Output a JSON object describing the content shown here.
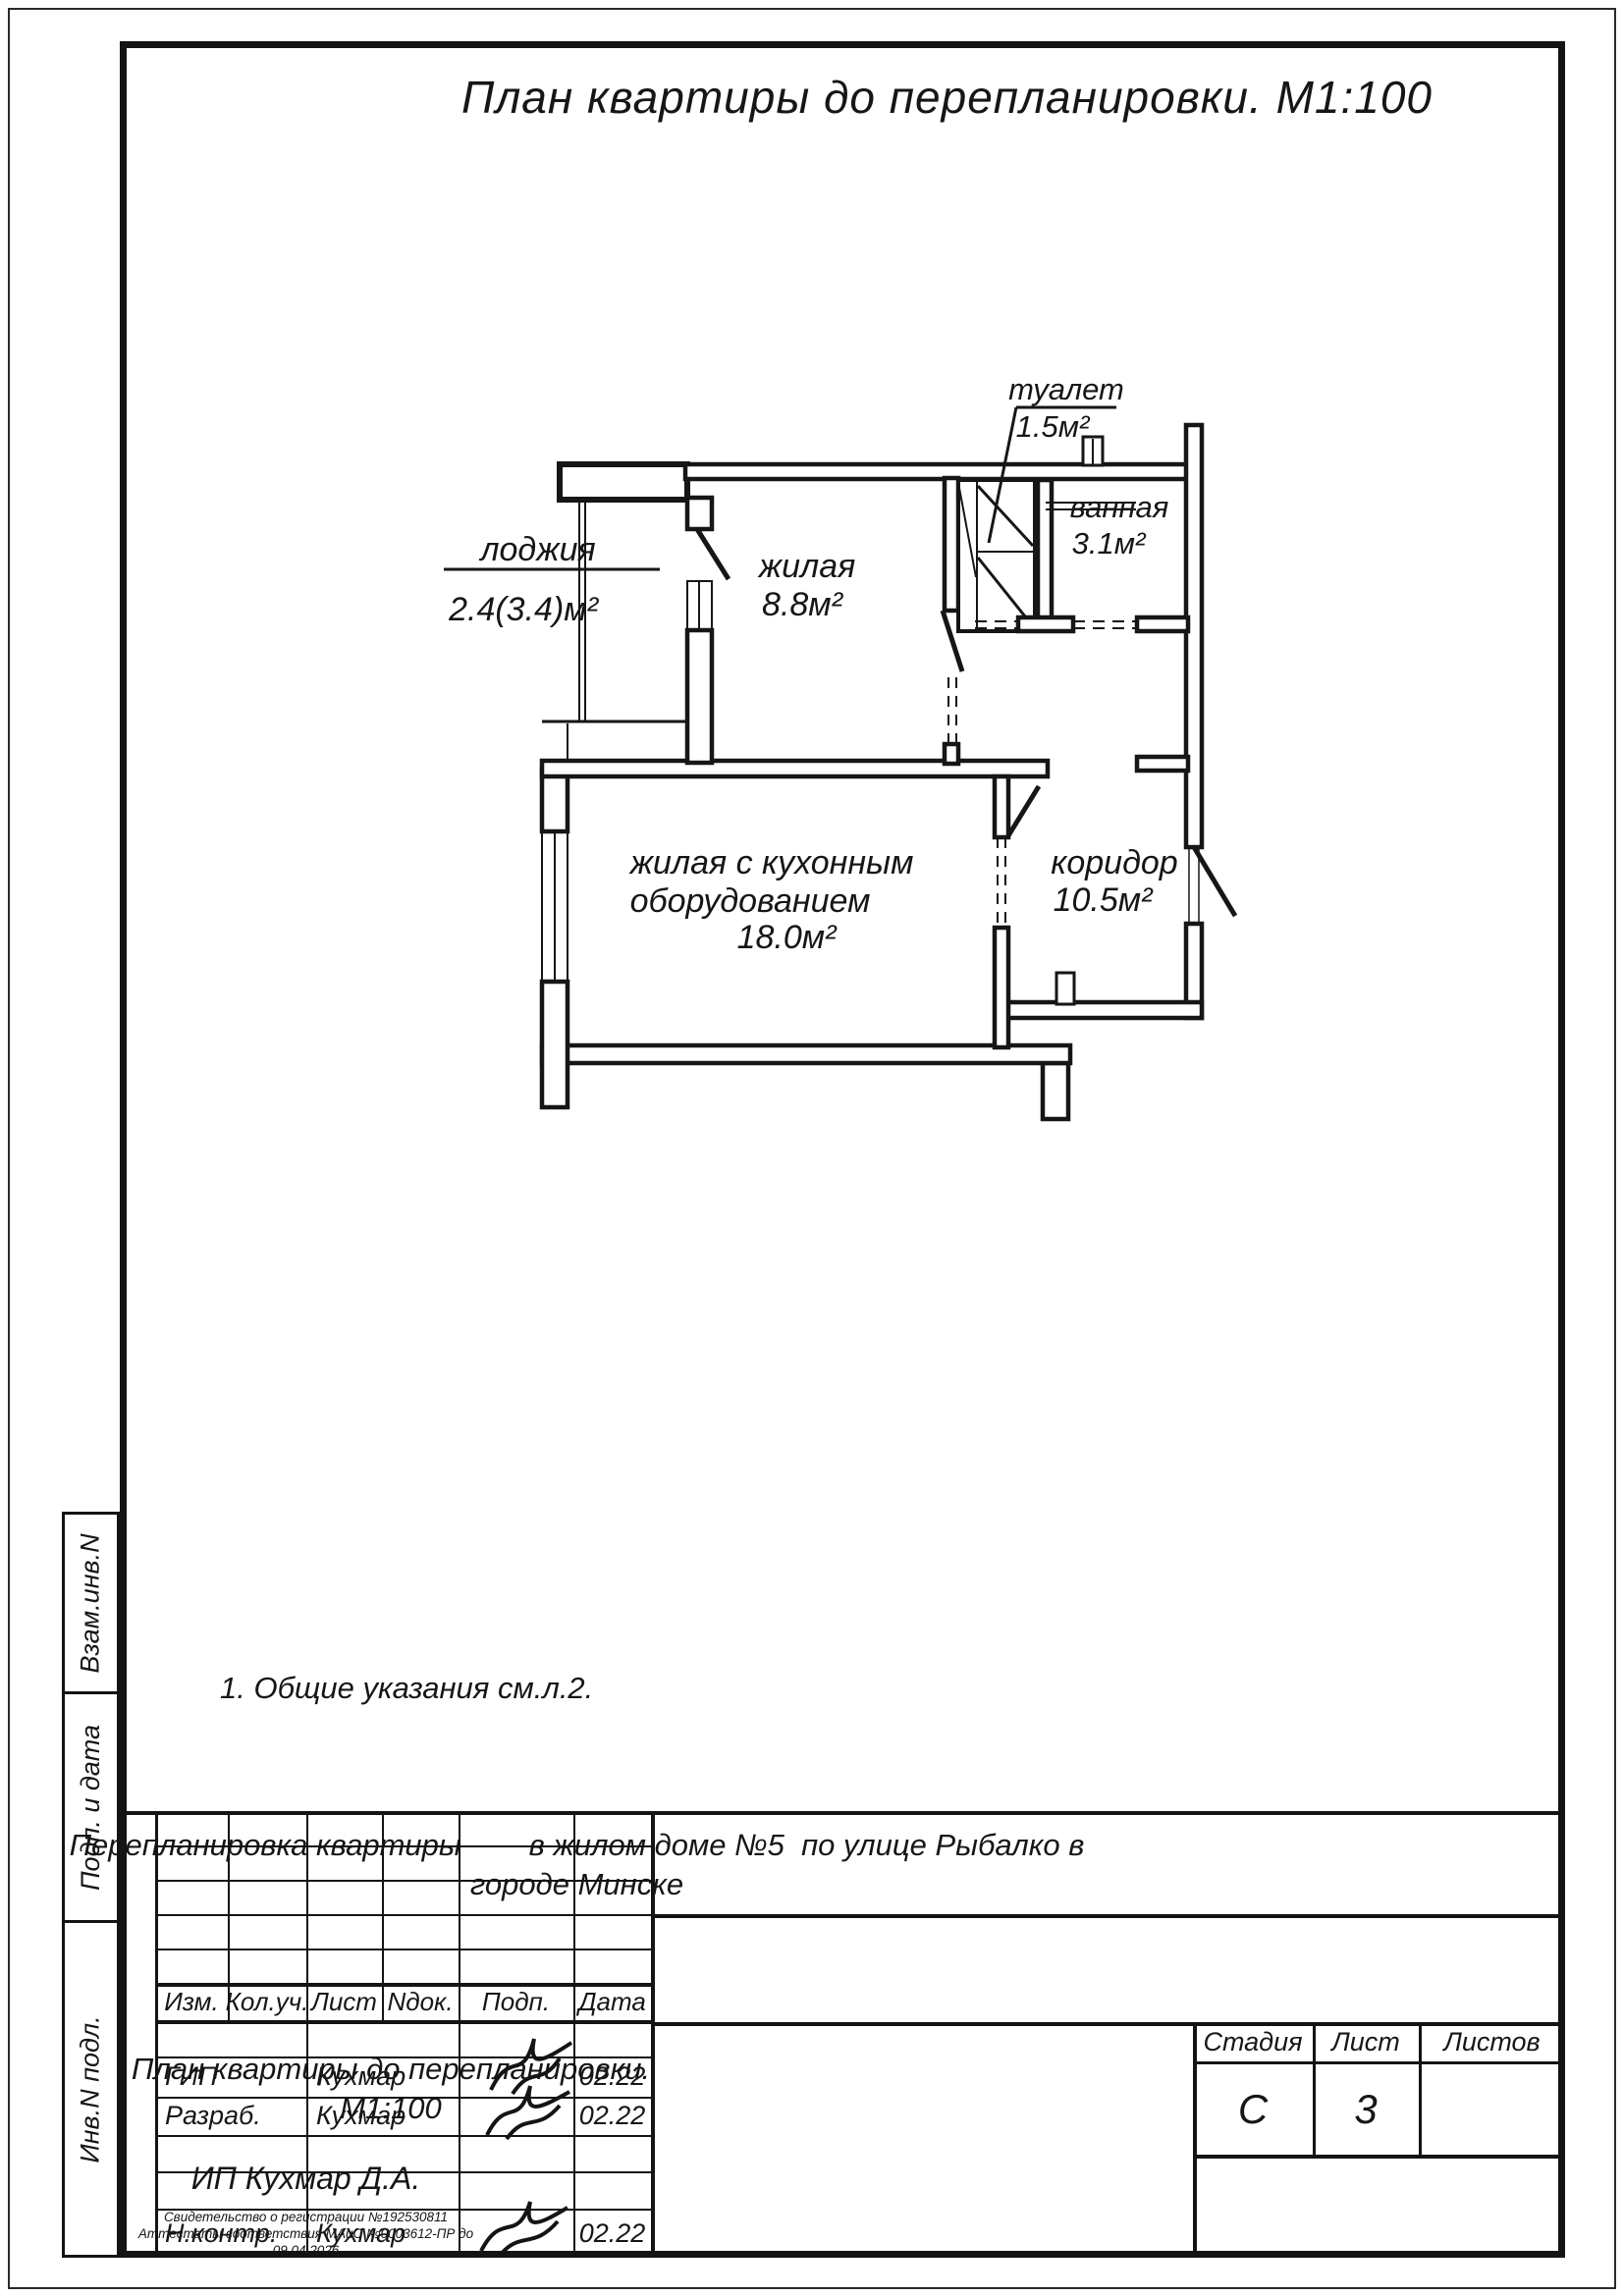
{
  "sheet": {
    "title": "План квартиры до перепланировки. М1:100",
    "note": "1. Общие указания см.л.2."
  },
  "plan": {
    "loggia": {
      "name": "лоджия",
      "area": "2.4(3.4)м²"
    },
    "living_small": {
      "name": "жилая",
      "area": "8.8м²"
    },
    "toilet": {
      "name": "туалет",
      "area": "1.5м²"
    },
    "bathroom": {
      "name": "ванная",
      "area": "3.1м²"
    },
    "living_kitchen": {
      "name1": "жилая с кухонным",
      "name2": "оборудованием",
      "area": "18.0м²"
    },
    "corridor": {
      "name": "коридор",
      "area": "10.5м²"
    }
  },
  "side_labels": {
    "vzam": "Взам.инв.N",
    "podp": "Подп. и дата",
    "inv": "Инв.N подл."
  },
  "title_block": {
    "cols": [
      "Изм.",
      "Кол.уч.",
      "Лист",
      "Nдок.",
      "Подп.",
      "Дата"
    ],
    "rows": {
      "gip": {
        "role": "ГИП",
        "name": "Кухмар",
        "date": "02.22"
      },
      "razrab": {
        "role": "Разраб.",
        "name": "Кухмар",
        "date": "02.22"
      },
      "nkontr": {
        "role": "Н.контр.",
        "name": "Кухмар",
        "date": "02.22"
      }
    },
    "project_line1": "Перепланировка квартиры        в жилом доме №5  по улице Рыбалко в",
    "project_line2": "городе Минске",
    "stage_label": "Стадия",
    "sheet_label": "Лист",
    "sheets_label": "Листов",
    "stage_value": "С",
    "sheet_value": "3",
    "sheets_value": "",
    "doc_title_line1": "План квартиры до перепланировки.",
    "doc_title_line2": "М1:100",
    "org_name": "ИП Кухмар Д.А.",
    "org_cert1": "Свидетельство о регистрации №192530811",
    "org_cert2": "Аттестаты соответствия МАиС №0003612-ПР до  09.04.2026"
  }
}
